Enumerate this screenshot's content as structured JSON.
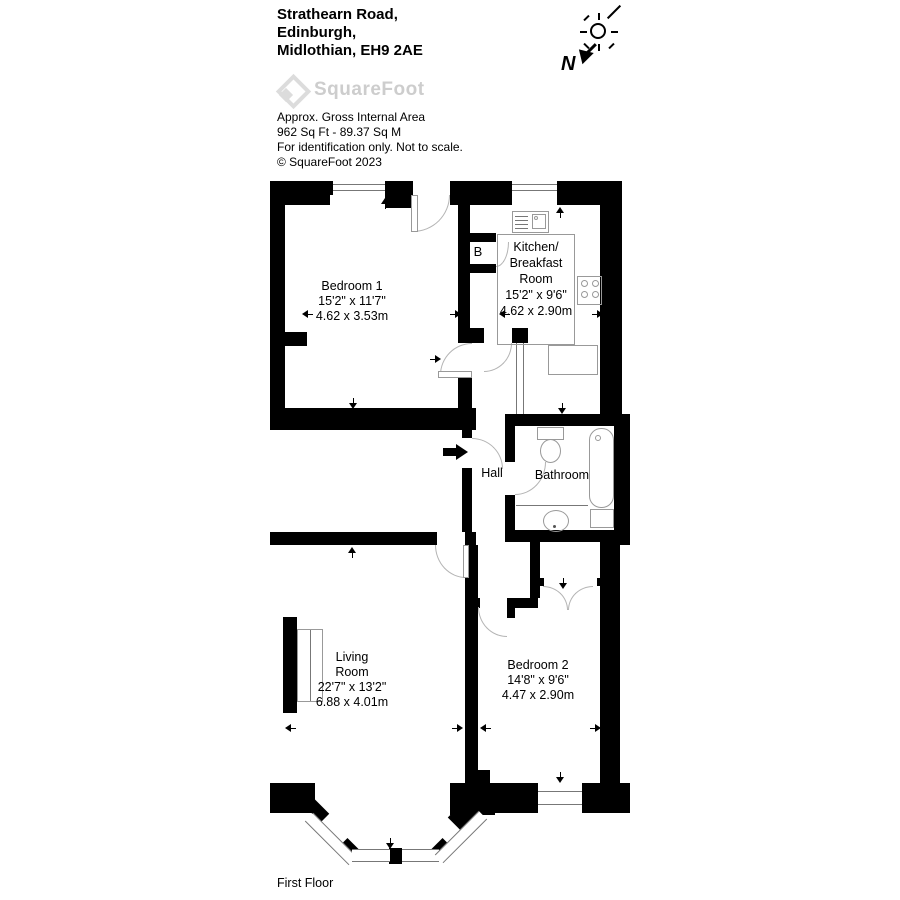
{
  "header": {
    "address_line1": "Strathearn Road,",
    "address_line2": "Edinburgh,",
    "address_line3": "Midlothian, EH9 2AE",
    "brand": "SquareFoot",
    "area_label": "Approx. Gross Internal Area",
    "area_value": "962 Sq Ft  -  89.37 Sq M",
    "disclaimer": "For identification only. Not to scale.",
    "copyright": "© SquareFoot 2023"
  },
  "compass": {
    "north_label": "N"
  },
  "floor_label": "First Floor",
  "rooms": {
    "bedroom1": {
      "name": "Bedroom 1",
      "dims_imperial": "15'2\" x 11'7\"",
      "dims_metric": "4.62 x 3.53m"
    },
    "kitchen": {
      "name_line1": "Kitchen/",
      "name_line2": "Breakfast",
      "name_line3": "Room",
      "dims_imperial": "15'2\" x 9'6\"",
      "dims_metric": "4.62 x 2.90m"
    },
    "hall": {
      "name": "Hall"
    },
    "bathroom": {
      "name": "Bathroom"
    },
    "living": {
      "name_line1": "Living",
      "name_line2": "Room",
      "dims_imperial": "22'7\" x 13'2\"",
      "dims_metric": "6.88 x 4.01m"
    },
    "bedroom2": {
      "name": "Bedroom 2",
      "dims_imperial": "14'8\" x 9'6\"",
      "dims_metric": "4.47 x 2.90m"
    },
    "boiler": {
      "label": "B"
    }
  },
  "colors": {
    "wall": "#000000",
    "arc": "#b4b4b4",
    "fixture": "#999999",
    "logo": "#cdcdcd"
  }
}
